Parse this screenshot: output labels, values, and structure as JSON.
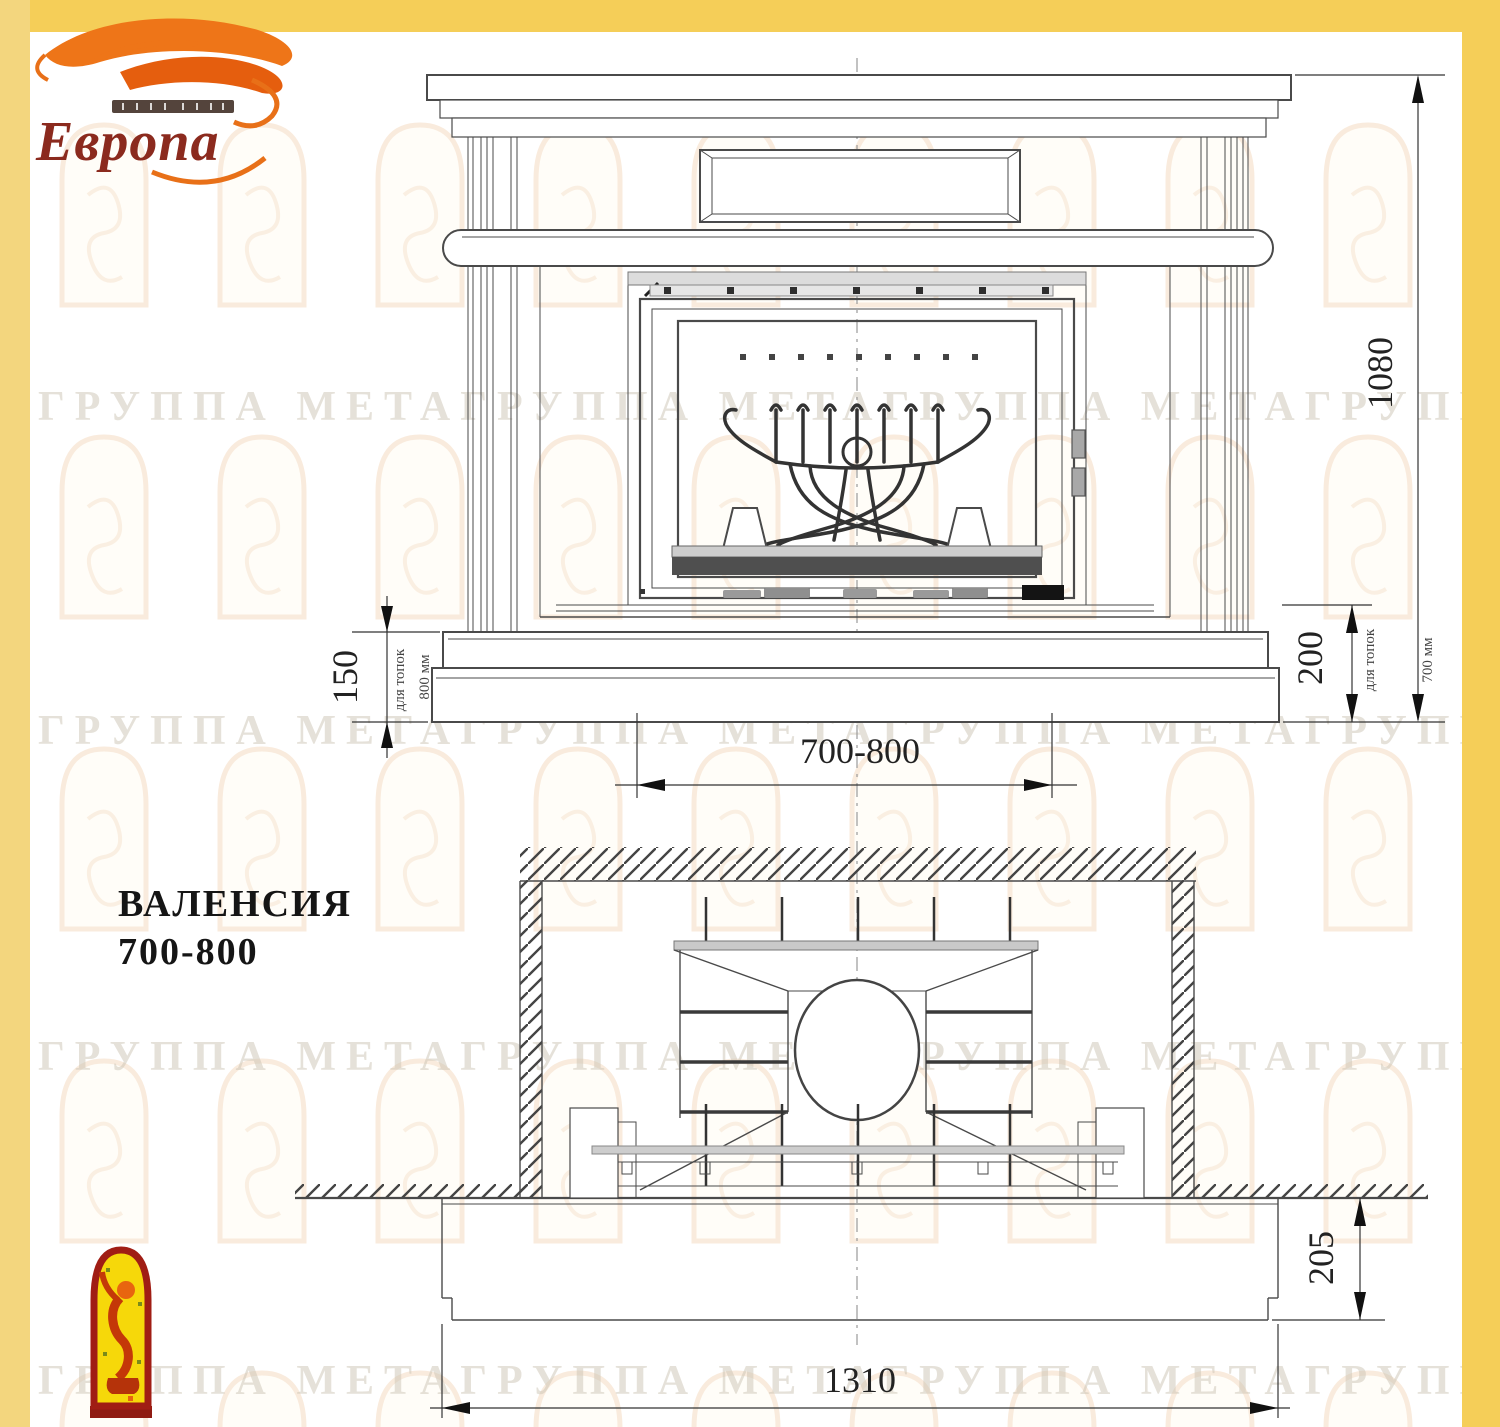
{
  "frame": {
    "color": "#F5CE58",
    "left_color": "#F3D67E"
  },
  "logo": {
    "name": "Европа"
  },
  "watermark": {
    "text": "ГРУППА МЕТАГРУППА МЕТАГРУППА МЕТАГРУППА МЕТА"
  },
  "title": {
    "model": "ВАЛЕНСИЯ",
    "size": "700-800"
  },
  "front_view": {
    "dim_height": "1080",
    "dim_hearth_left": "150",
    "dim_hearth_right": "200",
    "dim_firebox_width": "700-800",
    "note_left_line1": "для топок",
    "note_left_line2": "800 мм",
    "note_right_line1": "для топок",
    "note_right_line2": "700 мм"
  },
  "plan_view": {
    "dim_width": "1310",
    "dim_depth": "205"
  },
  "colors": {
    "drawing_line": "#4A4A4A",
    "logo_orange": "#EE7518",
    "logo_dark_red": "#8B2A1E",
    "emblem_red": "#A01D14",
    "emblem_yellow": "#F6D80A"
  }
}
